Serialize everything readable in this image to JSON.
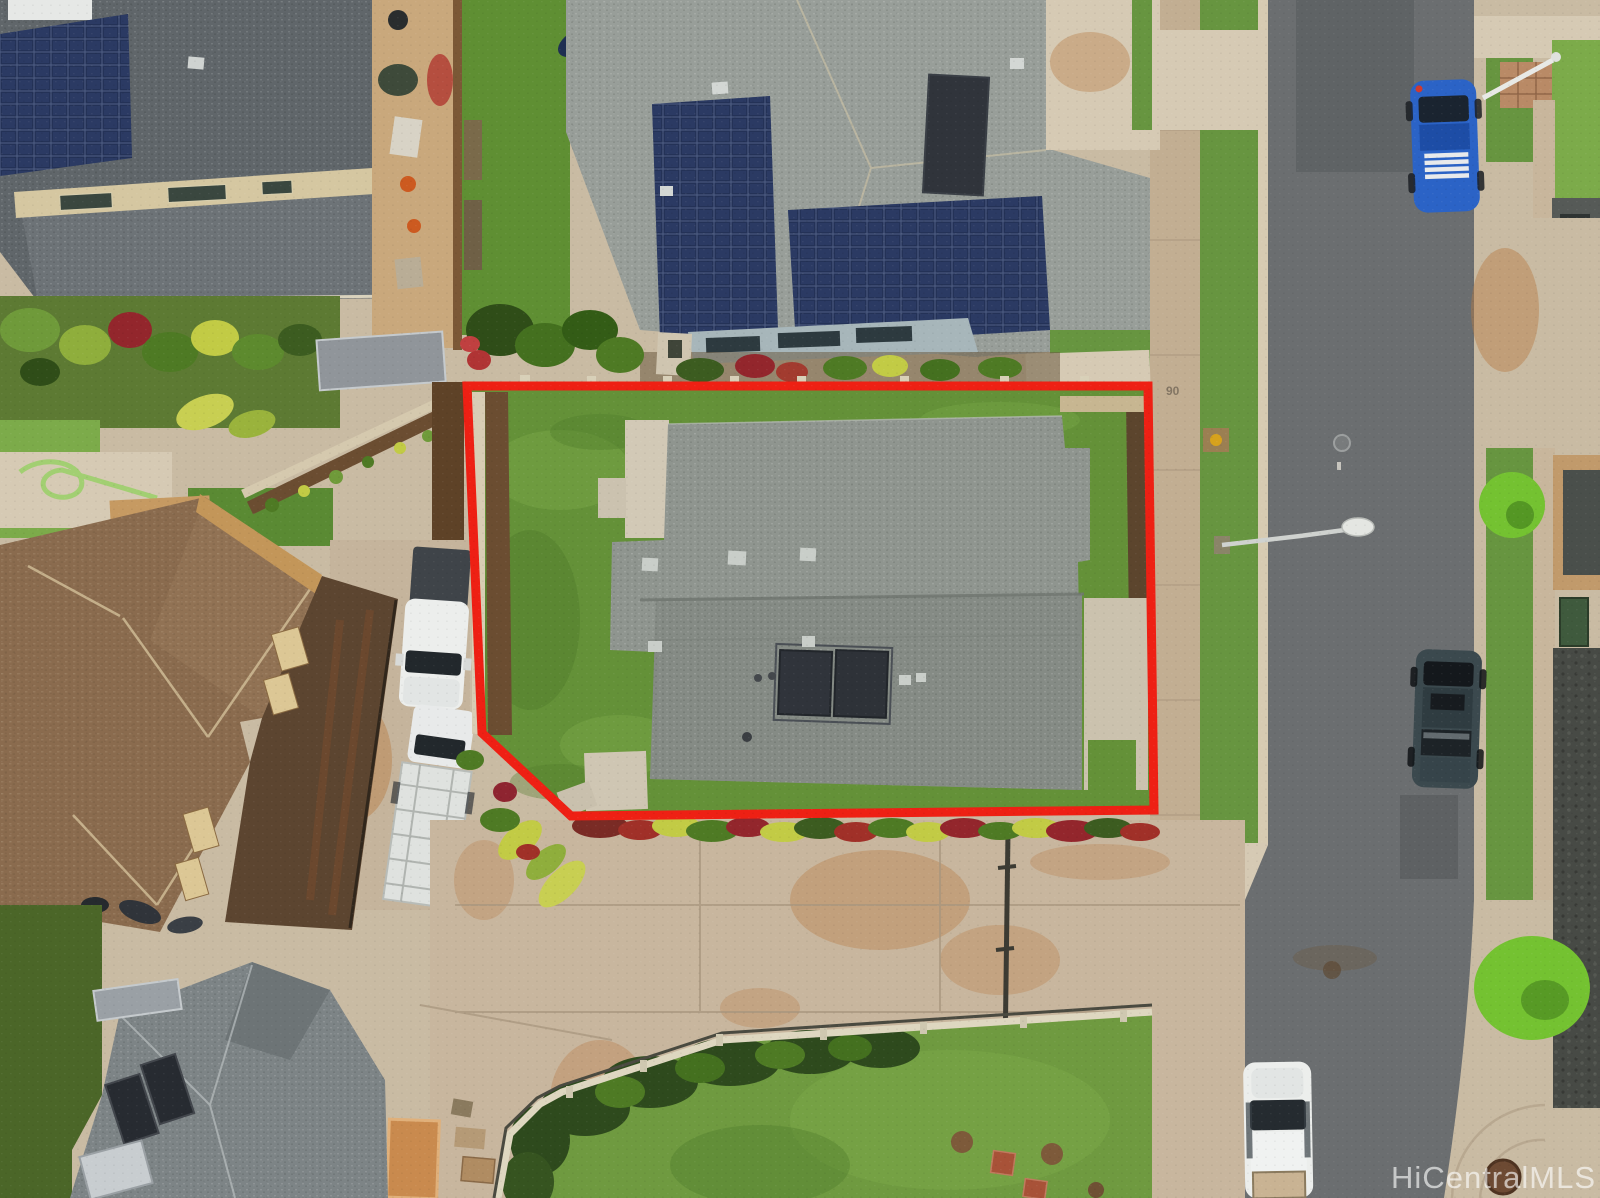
{
  "meta": {
    "kind": "aerial-drone-photo",
    "subject": "single-family home parcel outlined in red, Hawaii residential subdivision",
    "width": 1600,
    "height": 1198
  },
  "watermark": {
    "text": "HiCentralMLS"
  },
  "street": {
    "curb_address_text": "90"
  },
  "palette": {
    "boundary_red": "#ee2014",
    "asphalt": "#6b6e70",
    "asphalt_dark": "#54585a",
    "concrete": "#c9bba3",
    "concrete_light": "#d6cab4",
    "sidewalk": "#c2ae92",
    "curb": "#d7cbb2",
    "stain_orange": "#b97c45",
    "grass": "#679540",
    "grass_bright": "#7cab4a",
    "grass_dark": "#4f7c2c",
    "lawn_subject": "#649138",
    "turf_dark": "#4b6628",
    "roof_subject": "#8f958f",
    "roof_subject_shade": "#858b85",
    "roof_north": "#989e99",
    "roof_nw": "#60666a",
    "roof_sw": "#7d8486",
    "roof_brown": "#8a6b4e",
    "wall_brown": "#5c4530",
    "trim_cream": "#dcc795",
    "solar_navy": "#243257",
    "solar_heater": "#30343b",
    "mulch": "#6b4d31",
    "fence_brown": "#7b5836",
    "fence_light": "#ded7c0",
    "hedge_dark": "#2e4a1d",
    "foliage_green": "#4e7a24",
    "foliage_yellow": "#c2cb45",
    "foliage_red": "#93262c",
    "bush_bright": "#74c231",
    "rock_wall": "#474a45",
    "vehicle_white": "#eceeec",
    "vehicle_blue": "#2b63c6",
    "vehicle_dark": "#3b494e",
    "glass_dark": "#22282c",
    "watermark_white": "#ffffff"
  }
}
